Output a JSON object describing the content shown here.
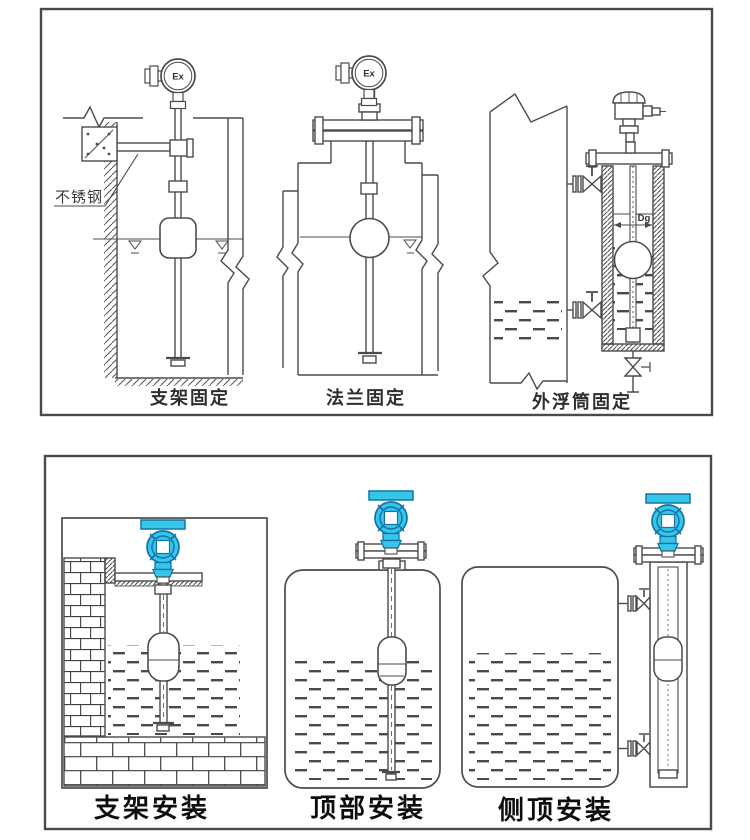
{
  "colors": {
    "line": "#4b4b4b",
    "panel_border": "#4a4a4a",
    "transmitter_fill": "#35C7E8",
    "transmitter_outline": "#1572A8",
    "label_top": "#2e2e2e",
    "label_bottom": "#0d0d0d"
  },
  "top_panel": {
    "annotation": "不锈钢",
    "diagrams": [
      {
        "label": "支架固定",
        "head_label": "Ex"
      },
      {
        "label": "法兰固定",
        "head_label": "Ex"
      },
      {
        "label": "外浮筒固定",
        "pipe_label": "Dg"
      }
    ]
  },
  "bottom_panel": {
    "diagrams": [
      {
        "label": "支架安装"
      },
      {
        "label": "顶部安装"
      },
      {
        "label": "侧顶安装"
      }
    ]
  }
}
